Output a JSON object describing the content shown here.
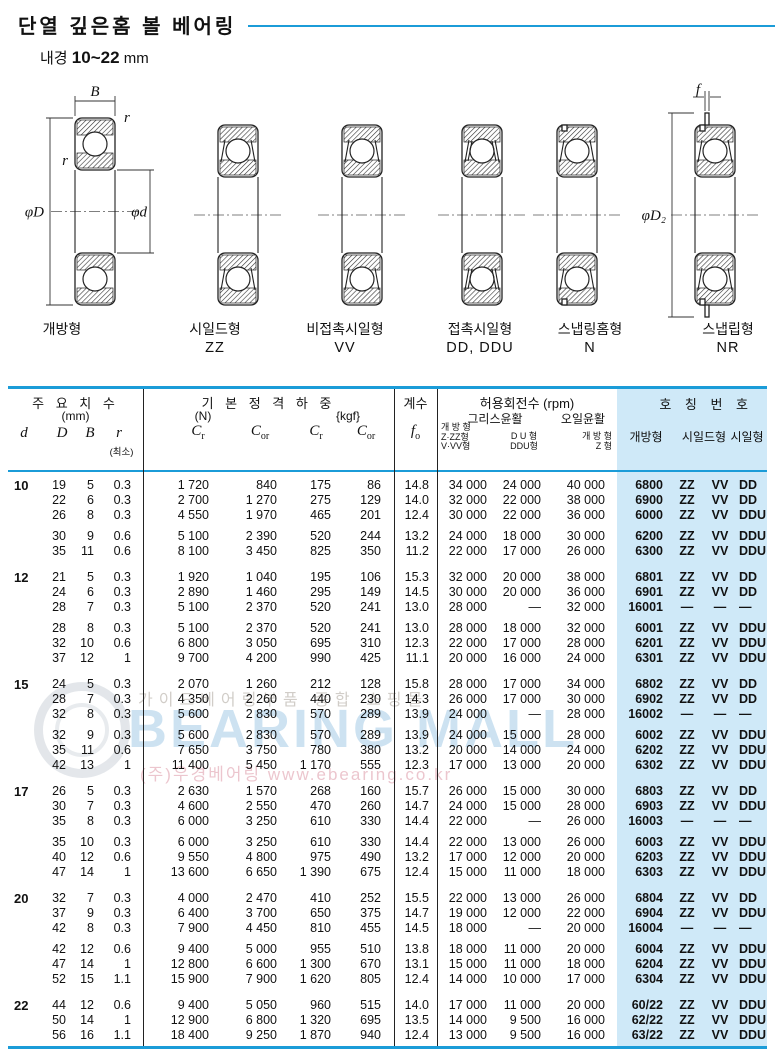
{
  "page": {
    "title": "단열 깊은홈 볼 베어링",
    "subtitle_label": "내경",
    "subtitle_value": "10~22",
    "subtitle_unit": "mm"
  },
  "diagrams": [
    {
      "name": "개방형",
      "code": ""
    },
    {
      "name": "시일드형",
      "code": "ZZ"
    },
    {
      "name": "비접촉시일형",
      "code": "VV"
    },
    {
      "name": "접촉시일형",
      "code": "DD, DDU"
    },
    {
      "name": "스냅링홈형",
      "code": "N"
    },
    {
      "name": "스냅립형",
      "code": "NR"
    }
  ],
  "dim_labels": {
    "B": "B",
    "r": "r",
    "phiD": "φD",
    "phid": "φd",
    "f": "f",
    "phiD2": "φD₂"
  },
  "colors": {
    "accent_blue": "#1b9cd8",
    "panel_blue": "#cfe9f8"
  },
  "table": {
    "headers": {
      "dims_title": "주 요 치 수",
      "dims_unit": "(mm)",
      "d": "d",
      "D": "D",
      "B": "B",
      "r": "r",
      "r_note": "(최소)",
      "load_title": "기 본 정 격 하 중",
      "load_unit_n": "(N)",
      "load_unit_kgf": "{kgf}",
      "load_syms": [
        {
          "b": "C",
          "s": "r"
        },
        {
          "b": "C",
          "s": "or"
        },
        {
          "b": "C",
          "s": "r"
        },
        {
          "b": "C",
          "s": "or"
        }
      ],
      "factor_title": "계수",
      "fo": {
        "b": "f",
        "s": "o"
      },
      "speed_title": "허용회전수 (rpm)",
      "grease": "그리스윤활",
      "oil": "오일윤활",
      "speed_col1": [
        "개 방 형",
        "Z·ZZ형",
        "V·VV형"
      ],
      "speed_col2": [
        "D U 형",
        "DDU형"
      ],
      "speed_col3": [
        "개 방 형",
        "Z 형"
      ],
      "number_title": "호 칭 번 호",
      "number_cols": [
        "개방형",
        "시일드형",
        "시일형"
      ]
    },
    "groups": [
      {
        "d": "10",
        "subgroups": [
          [
            [
              "19",
              "5",
              "0.3",
              "1 720",
              "840",
              "175",
              "86",
              "14.8",
              "34 000",
              "24 000",
              "40 000",
              "6800",
              "ZZ",
              "VV",
              "DD"
            ],
            [
              "22",
              "6",
              "0.3",
              "2 700",
              "1 270",
              "275",
              "129",
              "14.0",
              "32 000",
              "22 000",
              "38 000",
              "6900",
              "ZZ",
              "VV",
              "DD"
            ],
            [
              "26",
              "8",
              "0.3",
              "4 550",
              "1 970",
              "465",
              "201",
              "12.4",
              "30 000",
              "22 000",
              "36 000",
              "6000",
              "ZZ",
              "VV",
              "DDU"
            ]
          ],
          [
            [
              "30",
              "9",
              "0.6",
              "5 100",
              "2 390",
              "520",
              "244",
              "13.2",
              "24 000",
              "18 000",
              "30 000",
              "6200",
              "ZZ",
              "VV",
              "DDU"
            ],
            [
              "35",
              "11",
              "0.6",
              "8 100",
              "3 450",
              "825",
              "350",
              "11.2",
              "22 000",
              "17 000",
              "26 000",
              "6300",
              "ZZ",
              "VV",
              "DDU"
            ]
          ]
        ]
      },
      {
        "d": "12",
        "subgroups": [
          [
            [
              "21",
              "5",
              "0.3",
              "1 920",
              "1 040",
              "195",
              "106",
              "15.3",
              "32 000",
              "20 000",
              "38 000",
              "6801",
              "ZZ",
              "VV",
              "DD"
            ],
            [
              "24",
              "6",
              "0.3",
              "2 890",
              "1 460",
              "295",
              "149",
              "14.5",
              "30 000",
              "20 000",
              "36 000",
              "6901",
              "ZZ",
              "VV",
              "DD"
            ],
            [
              "28",
              "7",
              "0.3",
              "5 100",
              "2 370",
              "520",
              "241",
              "13.0",
              "28 000",
              "—",
              "32 000",
              "16001",
              "—",
              "—",
              "—"
            ]
          ],
          [
            [
              "28",
              "8",
              "0.3",
              "5 100",
              "2 370",
              "520",
              "241",
              "13.0",
              "28 000",
              "18 000",
              "32 000",
              "6001",
              "ZZ",
              "VV",
              "DDU"
            ],
            [
              "32",
              "10",
              "0.6",
              "6 800",
              "3 050",
              "695",
              "310",
              "12.3",
              "22 000",
              "17 000",
              "28 000",
              "6201",
              "ZZ",
              "VV",
              "DDU"
            ],
            [
              "37",
              "12",
              "1",
              "9 700",
              "4 200",
              "990",
              "425",
              "11.1",
              "20 000",
              "16 000",
              "24 000",
              "6301",
              "ZZ",
              "VV",
              "DDU"
            ]
          ]
        ]
      },
      {
        "d": "15",
        "subgroups": [
          [
            [
              "24",
              "5",
              "0.3",
              "2 070",
              "1 260",
              "212",
              "128",
              "15.8",
              "28 000",
              "17 000",
              "34 000",
              "6802",
              "ZZ",
              "VV",
              "DD"
            ],
            [
              "28",
              "7",
              "0.3",
              "4 350",
              "2 260",
              "440",
              "230",
              "14.3",
              "26 000",
              "17 000",
              "30 000",
              "6902",
              "ZZ",
              "VV",
              "DD"
            ],
            [
              "32",
              "8",
              "0.3",
              "5 600",
              "2 830",
              "570",
              "289",
              "13.9",
              "24 000",
              "—",
              "28 000",
              "16002",
              "—",
              "—",
              "—"
            ]
          ],
          [
            [
              "32",
              "9",
              "0.3",
              "5 600",
              "2 830",
              "570",
              "289",
              "13.9",
              "24 000",
              "15 000",
              "28 000",
              "6002",
              "ZZ",
              "VV",
              "DDU"
            ],
            [
              "35",
              "11",
              "0.6",
              "7 650",
              "3 750",
              "780",
              "380",
              "13.2",
              "20 000",
              "14 000",
              "24 000",
              "6202",
              "ZZ",
              "VV",
              "DDU"
            ],
            [
              "42",
              "13",
              "1",
              "11 400",
              "5 450",
              "1 170",
              "555",
              "12.3",
              "17 000",
              "13 000",
              "20 000",
              "6302",
              "ZZ",
              "VV",
              "DDU"
            ]
          ]
        ]
      },
      {
        "d": "17",
        "subgroups": [
          [
            [
              "26",
              "5",
              "0.3",
              "2 630",
              "1 570",
              "268",
              "160",
              "15.7",
              "26 000",
              "15 000",
              "30 000",
              "6803",
              "ZZ",
              "VV",
              "DD"
            ],
            [
              "30",
              "7",
              "0.3",
              "4 600",
              "2 550",
              "470",
              "260",
              "14.7",
              "24 000",
              "15 000",
              "28 000",
              "6903",
              "ZZ",
              "VV",
              "DDU"
            ],
            [
              "35",
              "8",
              "0.3",
              "6 000",
              "3 250",
              "610",
              "330",
              "14.4",
              "22 000",
              "—",
              "26 000",
              "16003",
              "—",
              "—",
              "—"
            ]
          ],
          [
            [
              "35",
              "10",
              "0.3",
              "6 000",
              "3 250",
              "610",
              "330",
              "14.4",
              "22 000",
              "13 000",
              "26 000",
              "6003",
              "ZZ",
              "VV",
              "DDU"
            ],
            [
              "40",
              "12",
              "0.6",
              "9 550",
              "4 800",
              "975",
              "490",
              "13.2",
              "17 000",
              "12 000",
              "20 000",
              "6203",
              "ZZ",
              "VV",
              "DDU"
            ],
            [
              "47",
              "14",
              "1",
              "13 600",
              "6 650",
              "1 390",
              "675",
              "12.4",
              "15 000",
              "11 000",
              "18 000",
              "6303",
              "ZZ",
              "VV",
              "DDU"
            ]
          ]
        ]
      },
      {
        "d": "20",
        "subgroups": [
          [
            [
              "32",
              "7",
              "0.3",
              "4 000",
              "2 470",
              "410",
              "252",
              "15.5",
              "22 000",
              "13 000",
              "26 000",
              "6804",
              "ZZ",
              "VV",
              "DD"
            ],
            [
              "37",
              "9",
              "0.3",
              "6 400",
              "3 700",
              "650",
              "375",
              "14.7",
              "19 000",
              "12 000",
              "22 000",
              "6904",
              "ZZ",
              "VV",
              "DDU"
            ],
            [
              "42",
              "8",
              "0.3",
              "7 900",
              "4 450",
              "810",
              "455",
              "14.5",
              "18 000",
              "—",
              "20 000",
              "16004",
              "—",
              "—",
              "—"
            ]
          ],
          [
            [
              "42",
              "12",
              "0.6",
              "9 400",
              "5 000",
              "955",
              "510",
              "13.8",
              "18 000",
              "11 000",
              "20 000",
              "6004",
              "ZZ",
              "VV",
              "DDU"
            ],
            [
              "47",
              "14",
              "1",
              "12 800",
              "6 600",
              "1 300",
              "670",
              "13.1",
              "15 000",
              "11 000",
              "18 000",
              "6204",
              "ZZ",
              "VV",
              "DDU"
            ],
            [
              "52",
              "15",
              "1.1",
              "15 900",
              "7 900",
              "1 620",
              "805",
              "12.4",
              "14 000",
              "10 000",
              "17 000",
              "6304",
              "ZZ",
              "VV",
              "DDU"
            ]
          ]
        ]
      },
      {
        "d": "22",
        "subgroups": [
          [
            [
              "44",
              "12",
              "0.6",
              "9 400",
              "5 050",
              "960",
              "515",
              "14.0",
              "17 000",
              "11 000",
              "20 000",
              "60/22",
              "ZZ",
              "VV",
              "DDU"
            ],
            [
              "50",
              "14",
              "1",
              "12 900",
              "6 800",
              "1 320",
              "695",
              "13.5",
              "14 000",
              "9 500",
              "16 000",
              "62/22",
              "ZZ",
              "VV",
              "DDU"
            ],
            [
              "56",
              "16",
              "1.1",
              "18 400",
              "9 250",
              "1 870",
              "940",
              "12.4",
              "13 000",
              "9 500",
              "16 000",
              "63/22",
              "ZZ",
              "VV",
              "DDU"
            ]
          ]
        ]
      }
    ]
  },
  "watermark": {
    "line1": "가이드베어링부품 종합 쇼핑몰",
    "main": "BEARING MALL",
    "line2": "(주)우경베어링 www.ebearing.co.kr"
  }
}
